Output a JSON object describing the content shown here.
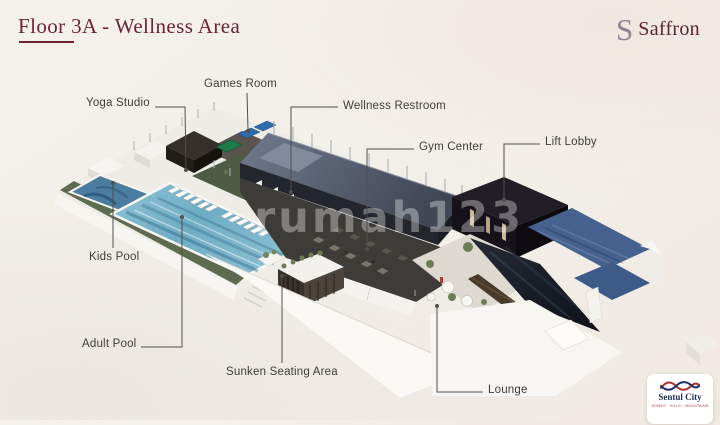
{
  "slide": {
    "title": "Floor 3A - Wellness Area",
    "watermark": "rumah123"
  },
  "brand": {
    "monogram": "S",
    "name": "Saffron"
  },
  "developer": {
    "name": "Sentul City",
    "tagline": "HOMES · HILLS · MOUNTAINS"
  },
  "colors": {
    "title": "#6e2431",
    "label": "#3d3d3d",
    "connector": "#4f4f4f",
    "background": "#f2efe9",
    "pool_water": "#6fadc4",
    "kids_pool_water": "#4a7da0",
    "roof_slate": "#4a5363",
    "lounge_glass": "#1a1d24",
    "lounge_roof_blue": "#47628e",
    "hedge_green": "#5d6b4f"
  },
  "labels": [
    {
      "id": "yoga-studio",
      "text": "Yoga Studio",
      "x": 86,
      "y": 97,
      "line": [
        [
          155,
          107
        ],
        [
          185,
          107
        ],
        [
          186,
          168
        ]
      ],
      "dot": [
        186,
        170
      ]
    },
    {
      "id": "games-room",
      "text": "Games Room",
      "x": 204,
      "y": 78,
      "line": [
        [
          247,
          93
        ],
        [
          248,
          129
        ]
      ],
      "dot": [
        248,
        131
      ]
    },
    {
      "id": "wellness-restroom",
      "text": "Wellness Restroom",
      "x": 343,
      "y": 100,
      "line": [
        [
          338,
          107
        ],
        [
          291,
          107
        ],
        [
          291,
          190
        ]
      ],
      "dot": [
        291,
        192
      ]
    },
    {
      "id": "gym-center",
      "text": "Gym Center",
      "x": 419,
      "y": 141,
      "line": [
        [
          414,
          149
        ],
        [
          367,
          149
        ],
        [
          367,
          247
        ]
      ],
      "dot": [
        367,
        249
      ]
    },
    {
      "id": "lift-lobby",
      "text": "Lift Lobby",
      "x": 545,
      "y": 136,
      "line": [
        [
          540,
          144
        ],
        [
          504,
          144
        ],
        [
          504,
          198
        ]
      ],
      "dot": [
        504,
        200
      ]
    },
    {
      "id": "kids-pool",
      "text": "Kids Pool",
      "x": 89,
      "y": 251,
      "line": [
        [
          113,
          248
        ],
        [
          113,
          185
        ]
      ],
      "dot": [
        113,
        183
      ]
    },
    {
      "id": "adult-pool",
      "text": "Adult Pool",
      "x": 82,
      "y": 338,
      "line": [
        [
          141,
          347
        ],
        [
          182,
          347
        ],
        [
          182,
          219
        ]
      ],
      "dot": [
        182,
        217
      ]
    },
    {
      "id": "sunken-seating-area",
      "text": "Sunken Seating Area",
      "x": 226,
      "y": 366,
      "line": [
        [
          282,
          363
        ],
        [
          282,
          278
        ]
      ],
      "dot": [
        282,
        276
      ]
    },
    {
      "id": "lounge",
      "text": "Lounge",
      "x": 488,
      "y": 384,
      "line": [
        [
          483,
          392
        ],
        [
          437,
          392
        ],
        [
          437,
          308
        ]
      ],
      "dot": [
        437,
        306
      ]
    }
  ]
}
